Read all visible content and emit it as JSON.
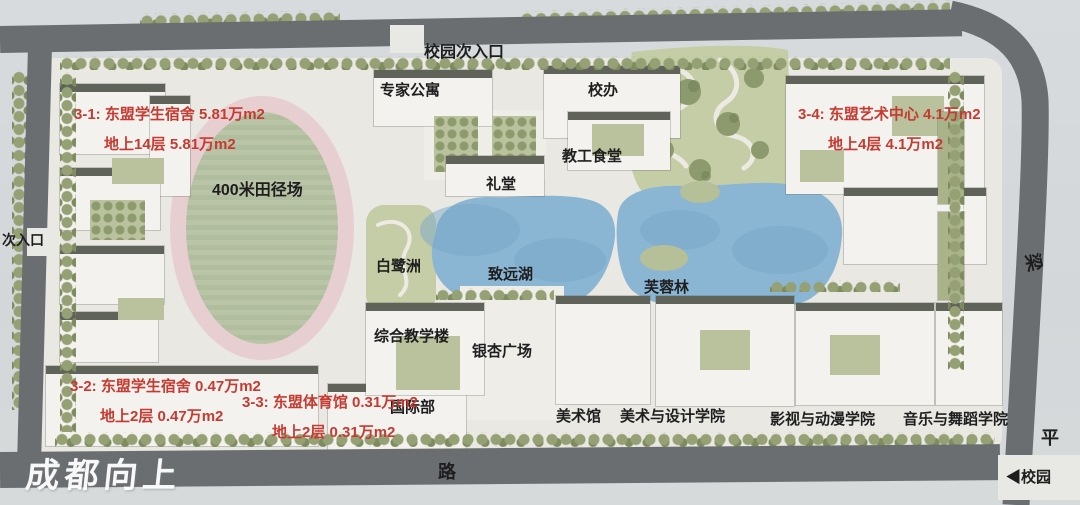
{
  "map": {
    "watermark": "成都向上",
    "entrances": {
      "top": "校园次入口",
      "left": "次入口",
      "bottom_right": "◀校园"
    },
    "roads": {
      "bottom": "路",
      "right_upper": "梁",
      "right_lower": "平"
    },
    "places": {
      "track": "400米田径场",
      "expert_apartment": "专家公寓",
      "school_office": "校办",
      "staff_canteen": "教工食堂",
      "auditorium": "礼堂",
      "egret_isle": "白鹭洲",
      "lake": "致远湖",
      "hibiscus_forest": "芙蓉林",
      "teaching_building": "综合教学楼",
      "ginkgo_square": "银杏广场",
      "international_dept": "国际部",
      "art_museum": "美术馆",
      "art_design_college": "美术与设计学院",
      "film_animation_college": "影视与动漫学院",
      "music_dance_college": "音乐与舞蹈学院"
    },
    "annotations": [
      {
        "id": "3-1",
        "line1": "3-1: 东盟学生宿舍  5.81万m2",
        "line2": "地上14层    5.81万m2"
      },
      {
        "id": "3-4",
        "line1": "3-4: 东盟艺术中心  4.1万m2",
        "line2": "地上4层    4.1万m2"
      },
      {
        "id": "3-2",
        "line1": "3-2: 东盟学生宿舍  0.47万m2",
        "line2": "地上2层    0.47万m2"
      },
      {
        "id": "3-3",
        "line1": "3-3: 东盟体育馆  0.31万m2",
        "line2": "地上2层    0.31万m2"
      }
    ],
    "colors": {
      "lake": "#8ab5d3",
      "park_green": "#c5cda6",
      "tree_green": "#8d9a6d",
      "track_ring_pink": "#e7ced1",
      "field_green": "#b9c4a6",
      "road_gray": "#6a6e71",
      "building_white": "#f3f2ee",
      "annotation_red": "#c63a31",
      "label_black": "#1e1e1e",
      "watermark_white": "#ffffff"
    }
  }
}
